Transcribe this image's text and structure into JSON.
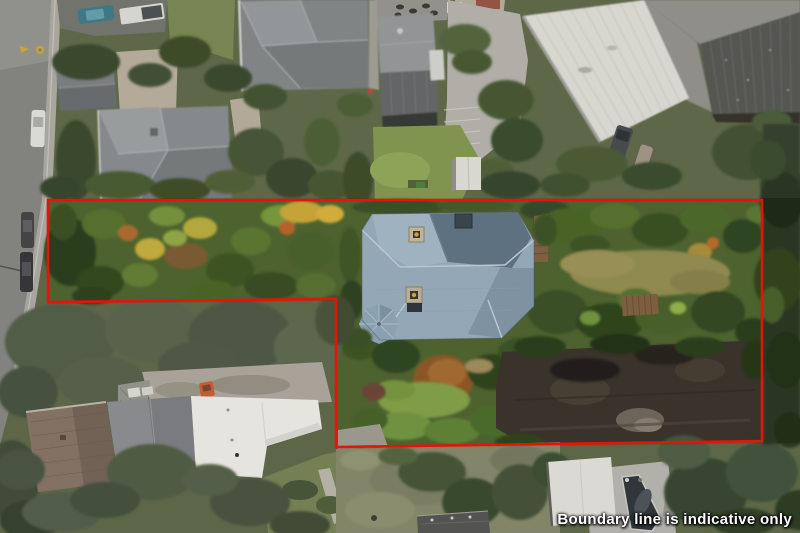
{
  "overlay": {
    "caption": "Boundary line is indicative only",
    "caption_color": "#ffffff",
    "boundary_color": "#e61408",
    "boundary_points": "48,200 762,200 762,441 336,447 336,299 48,302"
  }
}
